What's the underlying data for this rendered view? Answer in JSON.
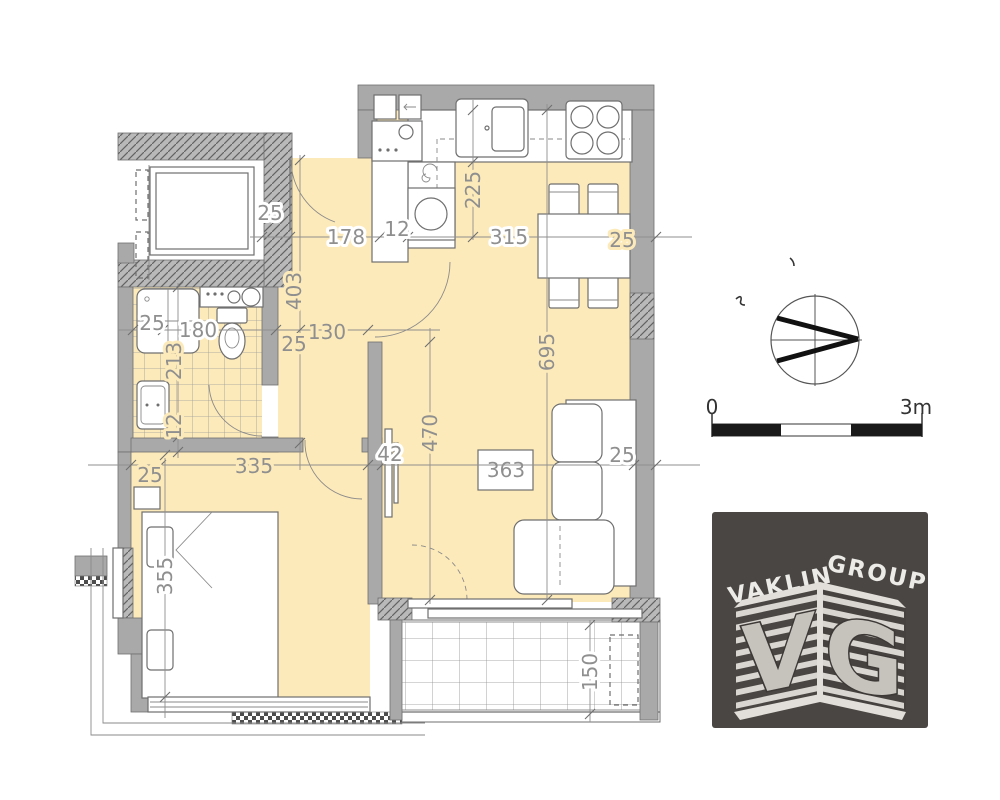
{
  "colors": {
    "floor": "#fdeaba",
    "wall": "#a9a9a9",
    "wall_edge": "#6f6f6f",
    "dim_text": "#8f8f8f",
    "scale_text": "#333333",
    "logo_bg": "#4a4643",
    "scale_bar_black": "#1a1a1a"
  },
  "dims": {
    "wall_top": "25",
    "entry_width": "178",
    "entry_jamb": "12",
    "kitchen_width": "315",
    "wall_right": "25",
    "kitchen_depth": "225",
    "hall_length": "403",
    "hall_wall": "25",
    "hall_opening": "130",
    "shower_width": "25",
    "bath_width": "180",
    "bath_length": "213",
    "bath_threshold": "12",
    "living_length": "695",
    "living_depth": "470",
    "bedroom_wall": "25",
    "bedroom_width": "335",
    "partition": "42",
    "living_span": "363",
    "sofa_wall": "25",
    "bedroom_length": "355",
    "balcony_depth": "150"
  },
  "scale_bar": {
    "start_label": "0",
    "end_label": "3m"
  },
  "logo": {
    "word_top_left": "VAKLIN",
    "word_top_right": "GROUP",
    "monogram_left": "V",
    "monogram_right": "G"
  }
}
